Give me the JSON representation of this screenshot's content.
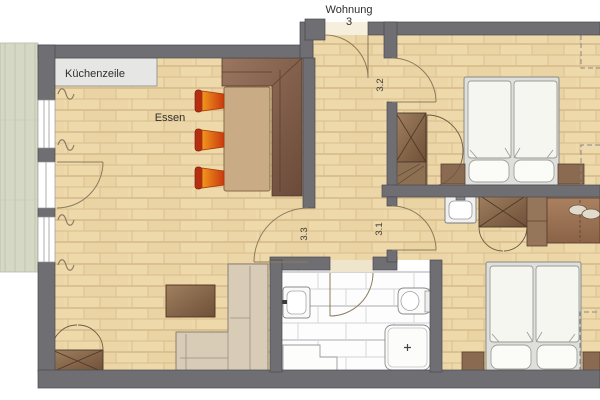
{
  "plan": {
    "apartment_label_line1": "Wohnung",
    "apartment_label_line2": "3",
    "kitchen_label": "Küchenzeile",
    "dining_label": "Essen",
    "door_numbers": {
      "hall_to_bedroom_top": "3.2",
      "hall_to_living_room": "3.3",
      "hall_to_bedroom_bottom": "3.1"
    }
  },
  "colors": {
    "wall": "#6f6e73",
    "wood_floor": "#eed9ab",
    "wood_line": "#d9bd8e",
    "tile_floor": "#fdfdfd",
    "balcony_deck": "#d4d8c4",
    "furniture_brown": "#8a6246",
    "chair_orange": "#e8871c",
    "sofa_beige": "#d8ccb7",
    "counter_gray": "#e6e6e4",
    "door_arc": "#8d7b5c"
  }
}
